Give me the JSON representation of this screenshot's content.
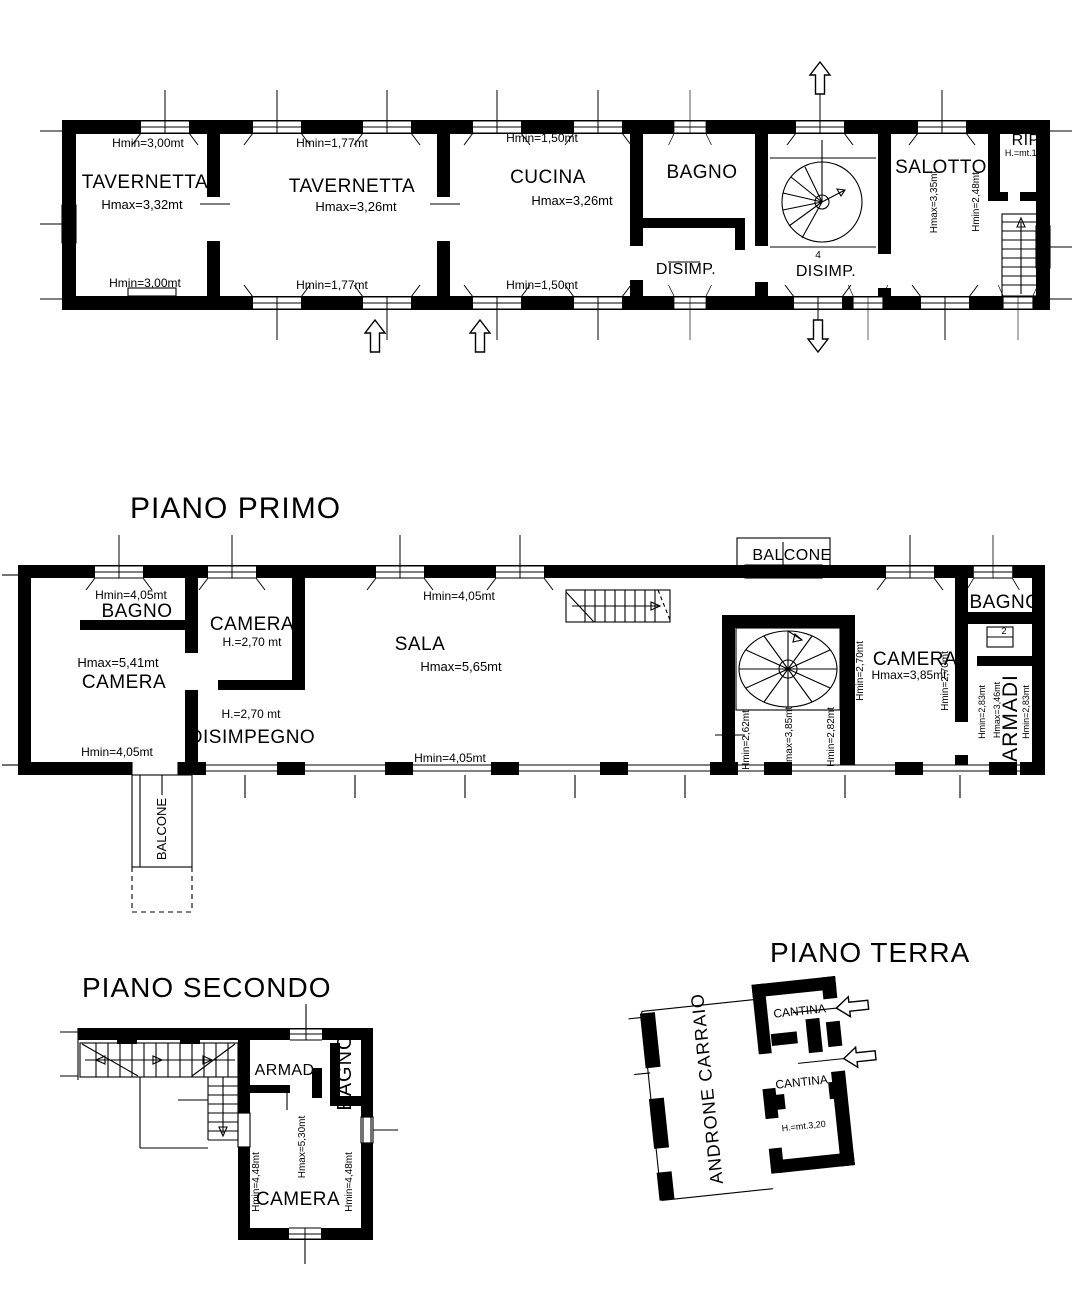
{
  "colors": {
    "ink": "#000000",
    "paper": "#ffffff"
  },
  "plans": {
    "seminterrato": {
      "rooms": {
        "tavernetta1": {
          "name": "TAVERNETTA",
          "hmin_top": "Hmin=3,00mt",
          "hmax": "Hmax=3,32mt",
          "hmin_bottom": "Hmin=3,00mt"
        },
        "tavernetta2": {
          "name": "TAVERNETTA",
          "hmin_top": "Hmin=1,77mt",
          "hmax": "Hmax=3,26mt",
          "hmin_bottom": "Hmin=1,77mt"
        },
        "cucina": {
          "name": "CUCINA",
          "hmin_top": "Hmin=1,50mt",
          "hmax": "Hmax=3,26mt",
          "hmin_bottom": "Hmin=1,50mt"
        },
        "bagno": {
          "name": "BAGNO"
        },
        "disimpegno1": {
          "name": "DISIMP."
        },
        "disimpegno2": {
          "name": "DISIMP."
        },
        "scala_chiocciola": {
          "hmin_left": "Hmin=2,48mt",
          "hmin_right": "Hmin=2,48mt",
          "step_number": "4"
        },
        "salotto": {
          "name": "SALOTTO",
          "hmax": "Hmax=3,35mt",
          "hmin": "Hmin=2,48mt"
        },
        "ripostiglio": {
          "name": "RIP.",
          "height": "H.=mt.1,60"
        }
      }
    },
    "piano_primo": {
      "title": "PIANO PRIMO",
      "rooms": {
        "balcone_nord": {
          "name": "BALCONE"
        },
        "bagno_ovest": {
          "name": "BAGNO",
          "hmin": "Hmin=4,05mt"
        },
        "camera_ovest": {
          "name": "CAMERA",
          "hmax": "Hmax=5,41mt",
          "hmin_bottom": "Hmin=4,05mt"
        },
        "camera_centro": {
          "name": "CAMERA",
          "height": "H.=2,70 mt"
        },
        "disimpegno": {
          "name": "DISIMPEGNO",
          "height": "H.=2,70 mt"
        },
        "sala": {
          "name": "SALA",
          "hmin_top": "Hmin=4,05mt",
          "hmax": "Hmax=5,65mt",
          "hmin_bottom": "Hmin=4,05mt"
        },
        "scala_chiocciola": {
          "hmin_left": "Hmin=2,62mt",
          "hmax": "Hmax=3,85mt",
          "hmin_right": "Hmin=2,82mt"
        },
        "camera_est": {
          "name": "CAMERA",
          "hmax": "Hmax=3,85mt",
          "hmin_left": "Hmin=2,70mt",
          "hmin_right": "Hmin=2,70mt"
        },
        "bagno_est": {
          "name": "BAGNO",
          "step_number": "2"
        },
        "armadi": {
          "name": "ARMADI",
          "hmax": "Hmax=3,46mt",
          "hmin_left": "Hmin=2,83mt",
          "hmin_right": "Hmin=2,83mt"
        },
        "balcone_sud": {
          "name": "BALCONE"
        }
      }
    },
    "piano_secondo": {
      "title": "PIANO SECONDO",
      "rooms": {
        "armadio": {
          "name": "ARMAD."
        },
        "bagno": {
          "name": "BAGNO"
        },
        "camera": {
          "name": "CAMERA",
          "hmax": "Hmax=5,30mt",
          "hmin_left": "Hmin=4,48mt",
          "hmin_right": "Hmin=4,48mt"
        }
      }
    },
    "piano_terra": {
      "title": "PIANO TERRA",
      "rooms": {
        "androne": {
          "name": "ANDRONE CARRAIO"
        },
        "cantina1": {
          "name": "CANTINA"
        },
        "cantina2": {
          "name": "CANTINA",
          "height": "H.=mt.3,20"
        }
      }
    }
  }
}
